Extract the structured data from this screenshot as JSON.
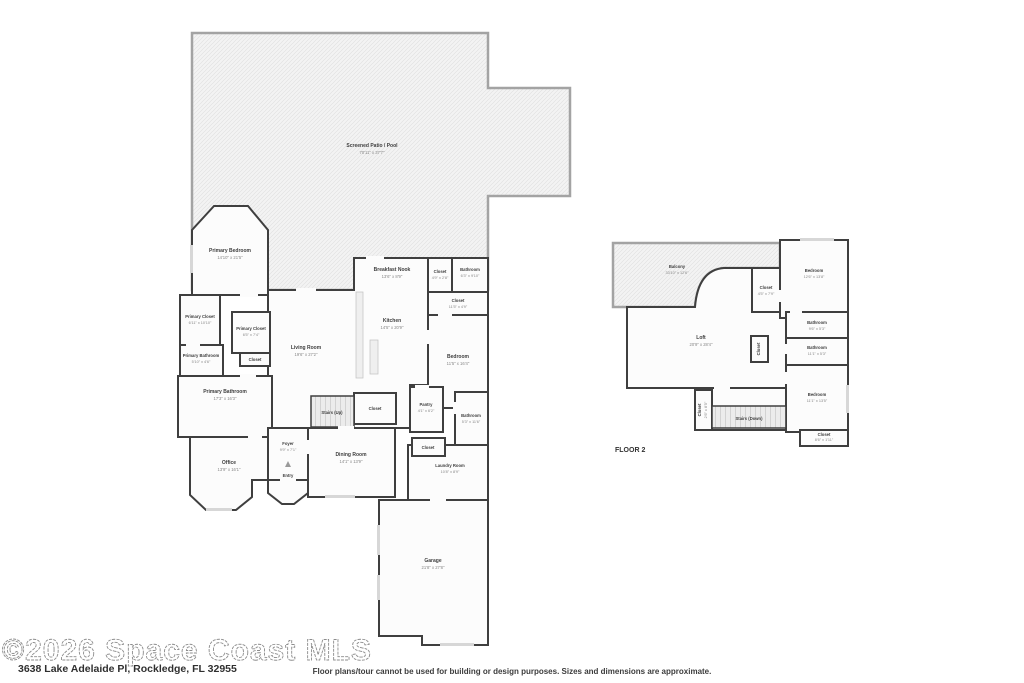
{
  "colors": {
    "wall": "#3f3f3f",
    "patio_fill": "#f3f3f3",
    "label_text": "#3e3e3e",
    "dims_text": "#868686"
  },
  "floor1": {
    "patio": {
      "name": "Screened Patio / Pool",
      "dims": "70'11\" x 37'7\""
    },
    "primary_bedroom": {
      "name": "Primary Bedroom",
      "dims": "14'10\" x 21'5\""
    },
    "primary_closet_1": {
      "name": "Primary Closet",
      "dims": "6'11\" x 10'10\""
    },
    "primary_closet_2": {
      "name": "Primary Closet",
      "dims": "6'5\" x 7'4\""
    },
    "closet_mid": {
      "name": "Closet"
    },
    "primary_bathroom_small": {
      "name": "Primary Bathroom",
      "dims": "5'10\" x 4'6\""
    },
    "primary_bathroom": {
      "name": "Primary Bathroom",
      "dims": "17'3\" x 16'3\""
    },
    "living_room": {
      "name": "Living Room",
      "dims": "19'6\" x 27'2\""
    },
    "breakfast_nook": {
      "name": "Breakfast Nook",
      "dims": "13'6\" x 8'9\""
    },
    "kitchen": {
      "name": "Kitchen",
      "dims": "14'5\" x 20'9\""
    },
    "bathroom_top": {
      "name": "Bathroom",
      "dims": "6'3\" x 9'10\""
    },
    "closet_top_small": {
      "name": "Closet",
      "dims": "4'9\" x 2'8\""
    },
    "closet_hall": {
      "name": "Closet",
      "dims": "11'5\" x 4'9\""
    },
    "bedroom": {
      "name": "Bedroom",
      "dims": "11'5\" x 16'4\""
    },
    "pantry": {
      "name": "Pantry",
      "dims": "4'1\" x 6'2\""
    },
    "bathroom_hall": {
      "name": "Bathroom",
      "dims": "5'3\" x 11'6\""
    },
    "stairs": {
      "name": "Stairs (Up)"
    },
    "closet_stairs": {
      "name": "Closet"
    },
    "closet_hall2": {
      "name": "Closet"
    },
    "dining_room": {
      "name": "Dining Room",
      "dims": "14'1\" x 13'9\""
    },
    "laundry_room": {
      "name": "Laundry Room",
      "dims": "10'8\" x 8'9\""
    },
    "foyer": {
      "name": "Foyer",
      "dims": "9'9\" x 7'1\""
    },
    "entry": {
      "name": "Entry"
    },
    "office": {
      "name": "Office",
      "dims": "13'9\" x 16'1\""
    },
    "garage": {
      "name": "Garage",
      "dims": "21'8\" x 27'8\""
    }
  },
  "floor2": {
    "title": "FLOOR 2",
    "balcony": {
      "name": "Balcony",
      "dims": "33'10\" x 12'6\""
    },
    "bedroom_top": {
      "name": "Bedroom",
      "dims": "12'6\" x 13'8\""
    },
    "closet_top": {
      "name": "Closet",
      "dims": "4'5\" x 7'9\""
    },
    "bathroom_top": {
      "name": "Bathroom",
      "dims": "9'6\" x 5'3\""
    },
    "bathroom_mid": {
      "name": "Bathroom",
      "dims": "11'1\" x 5'3\""
    },
    "loft": {
      "name": "Loft",
      "dims": "20'9\" x 28'4\""
    },
    "closet_mid": {
      "name": "Closet"
    },
    "bedroom_right": {
      "name": "Bedroom",
      "dims": "11'1\" x 13'5\""
    },
    "closet_left": {
      "name": "Closet",
      "dims": "2'6\" x 8'5\""
    },
    "stairs": {
      "name": "Stairs (Down)"
    },
    "closet_bottom": {
      "name": "Closet",
      "dims": "8'6\" x 1'11\""
    }
  },
  "footer": {
    "watermark": "©2026 Space Coast MLS",
    "address": "3638 Lake Adelaide Pl, Rockledge, FL 32955",
    "disclaimer": "Floor plans/tour cannot be used for building or design purposes. Sizes and dimensions are approximate."
  }
}
